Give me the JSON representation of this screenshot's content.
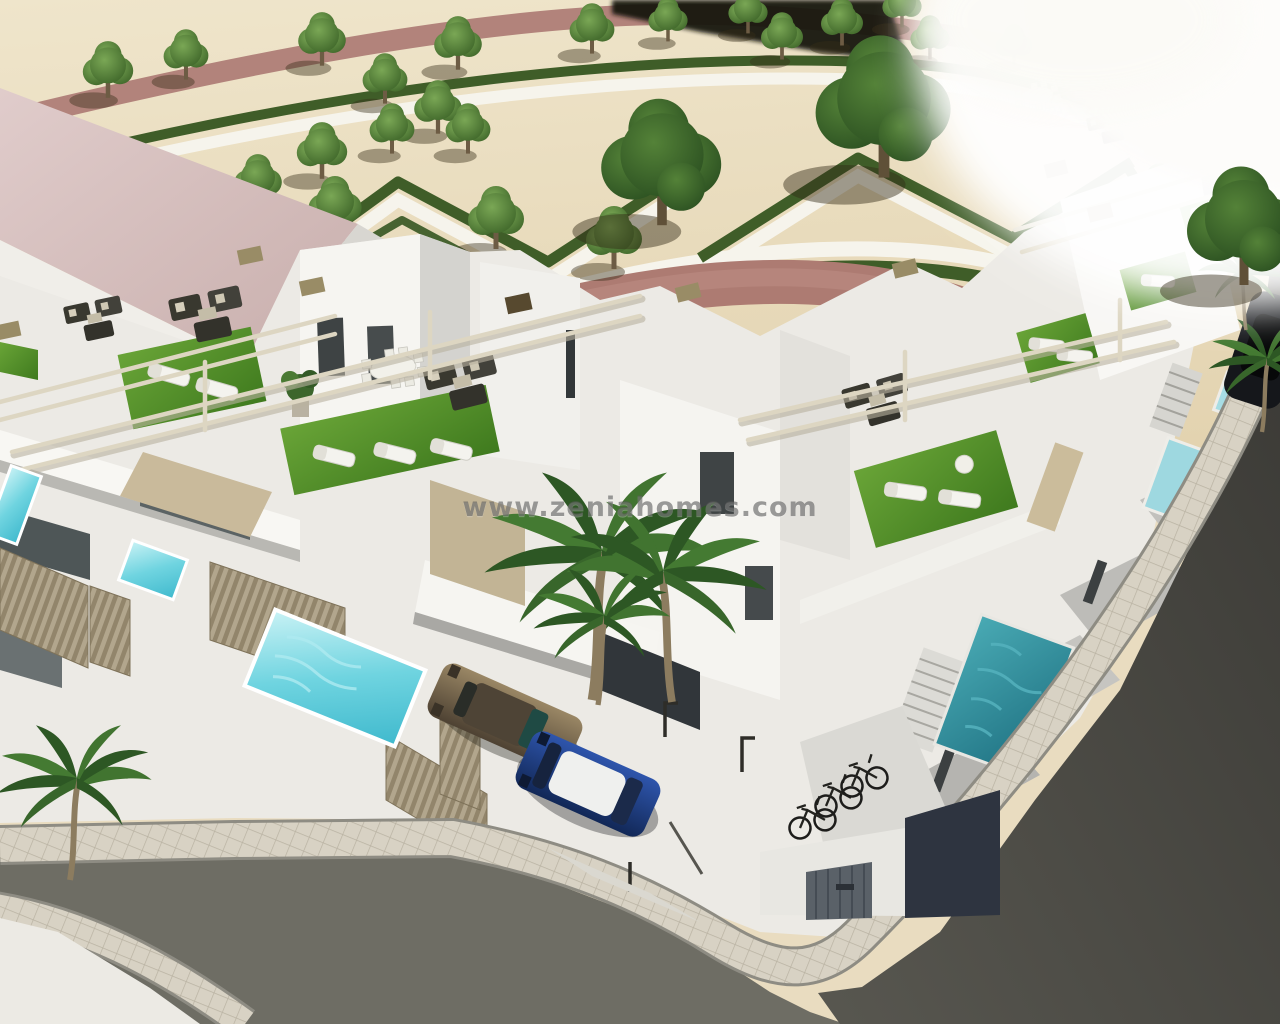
{
  "image": {
    "kind": "3d-architectural-render",
    "subject": "aerial-render-of-white-townhouse-development-with-roof-terraces-private-pools-palms-park-and-corner-street",
    "width_px": 1280,
    "height_px": 1024
  },
  "watermark": {
    "text": "www.zeniahomes.com",
    "color": "#5f5f5f",
    "opacity": 0.6
  },
  "palette": {
    "sand_ground": "#e9dcc0",
    "walkway_red": "#b0807a",
    "walkway_white": "#f6f4ec",
    "hedge_green": "#3f5d28",
    "tree_green": "#4c7a38",
    "wall_white": "#f3f2ee",
    "wall_shadow": "#c0bfba",
    "window_glass_dark": "#3e4344",
    "roof_pink": "#d9c3c2",
    "turf_green": "#53902c",
    "pool_cyan": "#5ecfdd",
    "pool_teal": "#2f8f9d",
    "fence_beige": "#b0a48c",
    "pergola_beige": "#ddd6c2",
    "asphalt_left_street": "#6e6d64",
    "asphalt_right_street": "#45443f",
    "sidewalk_paver": "#d6d0c2",
    "car_bronze": "#7d6b50",
    "car_blue": "#1f3f86",
    "car_roof_white": "#f0f0ee",
    "bike_black": "#1d1d1b"
  },
  "scene": {
    "objects": [
      "landscaped-park",
      "sand-gravel-ground",
      "red-walkways",
      "white-walkways",
      "hedge-parterres",
      "park-trees",
      "pink-roof-apartment-building",
      "white-townhouse-row",
      "rooftop-solariums",
      "artificial-turf",
      "sun-loungers",
      "outdoor-sofa-sets",
      "roof-dining-set",
      "pergola-beams",
      "potted-plants",
      "shade-sail",
      "private-pools",
      "plunge-pool-teal",
      "corrugated-fences",
      "balcony-slab",
      "carport",
      "bronze-car",
      "blue-car",
      "parked-dark-car",
      "bicycle-shelter",
      "bicycles",
      "storage-shed",
      "paver-sidewalk",
      "corner-sidewalk-curve",
      "asphalt-street-left",
      "asphalt-street-right",
      "bollards",
      "palm-trees",
      "watermark"
    ]
  }
}
